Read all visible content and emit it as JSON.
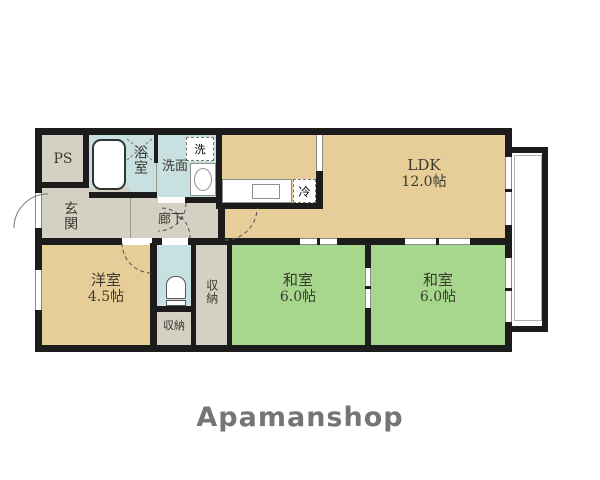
{
  "brand": {
    "name": "Apamanshop"
  },
  "rooms": {
    "ps": {
      "label": "PS"
    },
    "bath": {
      "label": "浴室"
    },
    "washroom": {
      "label": "洗面"
    },
    "washer": {
      "label": "洗"
    },
    "entrance": {
      "label": "玄関"
    },
    "hallway": {
      "label": "廊下"
    },
    "fridge": {
      "label": "冷"
    },
    "ldk": {
      "label": "LDK",
      "size": "12.0帖"
    },
    "western_room": {
      "label": "洋室",
      "size": "4.5帖"
    },
    "storage_hall": {
      "label": "収納"
    },
    "storage_side": {
      "label": "収納"
    },
    "japanese_room_1": {
      "label": "和室",
      "size": "6.0帖"
    },
    "japanese_room_2": {
      "label": "和室",
      "size": "6.0帖"
    }
  },
  "colors": {
    "wall": "#1c1c1c",
    "wood_floor": "#e7cd97",
    "tatami_green": "#a6d78d",
    "wet_area_blue": "#c9e0e0",
    "hall_gray": "#d4d0c3",
    "brand_text": "#757575"
  }
}
